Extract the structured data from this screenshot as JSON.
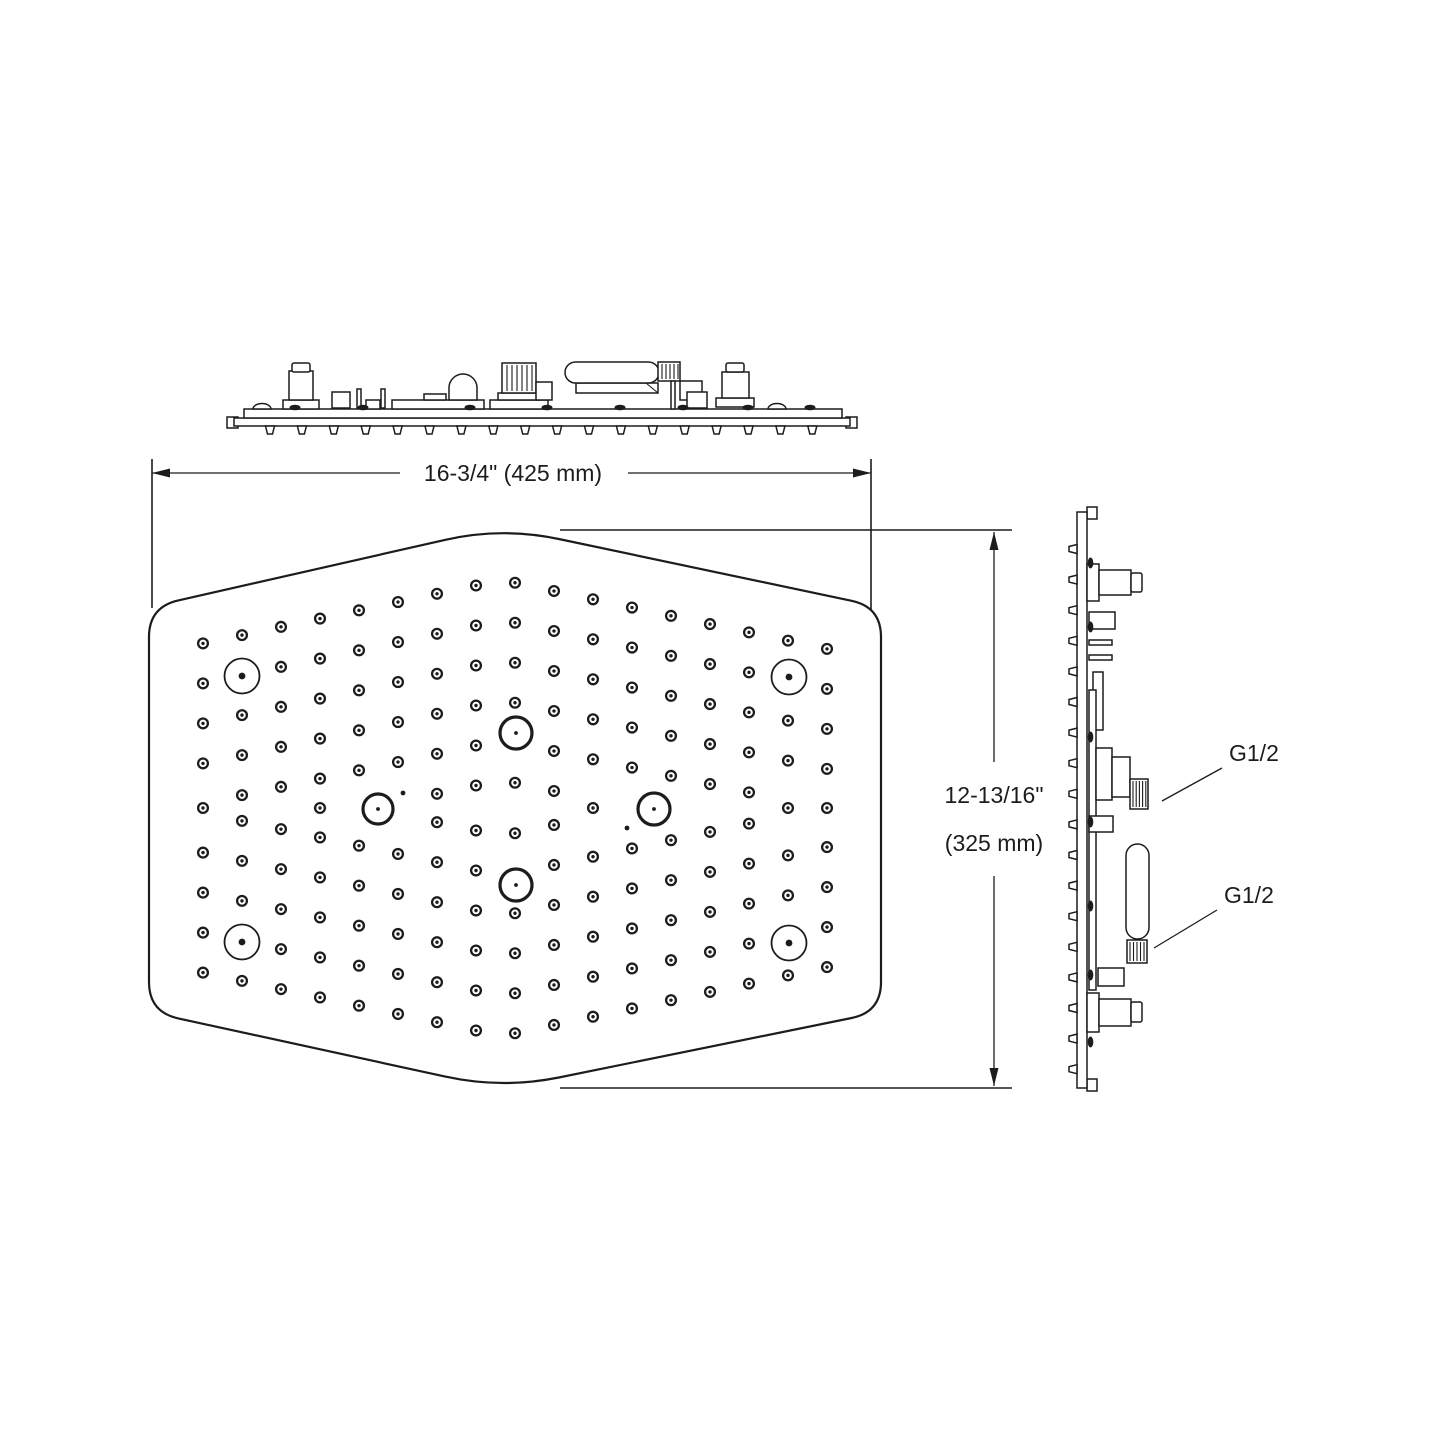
{
  "drawing": {
    "width_dimension": {
      "label": "16-3/4\" (425 mm)"
    },
    "height_dimension": {
      "label_line1": "12-13/16\"",
      "label_line2": "(325 mm)"
    },
    "connection_labels": {
      "upper": "G1/2",
      "lower": "G1/2"
    },
    "colors": {
      "line": "#1c1c1c",
      "background": "#ffffff"
    }
  }
}
